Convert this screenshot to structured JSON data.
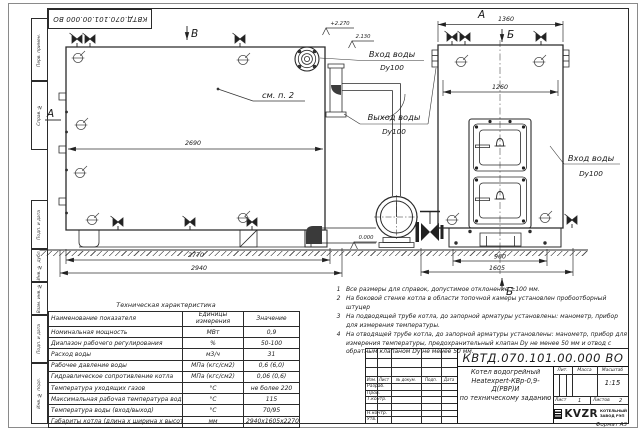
{
  "doc_number": "КВТД.070.101.00.000  ВО",
  "format_note": "Формат   А3",
  "margin_labels": {
    "perv_primen": "Перв. примен.",
    "sprav_no": "Справ. №",
    "podp_data_1": "Подп. и дата",
    "inv_dubl": "Инв. № дубл.",
    "vzam_inv": "Взам. инв. №",
    "podp_data_2": "Подп. и дата",
    "inv_podl": "Инв. № подл."
  },
  "side_view": {
    "view_b_label": "В",
    "view_a_label": "А",
    "see_note": "см. п. 2",
    "dim_top": "2690",
    "dim_mid": "2770",
    "dim_bottom": "2940",
    "elev_top": "+2.270",
    "elev_flue": "2.130",
    "elev_ground": "0.000",
    "inlet_label": "Вход воды",
    "inlet_dn": "Dy100",
    "outlet_label": "Выход воды",
    "outlet_dn": "Dy100"
  },
  "front_view": {
    "view_title": "А",
    "dim_top": "1360",
    "dim_inner": "1260",
    "dim_base": "960",
    "dim_overall": "1605",
    "section_top": "Б",
    "section_bottom": "Б",
    "inlet_label": "Вход воды",
    "inlet_dn": "Dy100"
  },
  "notes": [
    {
      "num": "1",
      "text": "Все размеры для справок, допустимое отклонение  ±100 мм."
    },
    {
      "num": "2",
      "text": "На боковой стенке котла в области топочной камеры установлен пробоотборный штуцер"
    },
    {
      "num": "3",
      "text": "На  подводящей трубе котла, до запорной арматуры установлены: манометр, прибор для измерения температуры."
    },
    {
      "num": "4",
      "text": "На отводящей трубе котла, до запорной арматуры установлены: манометр, прибор для измерения температуры, предохранительный клапан  Dy не менее  50 мм и отвод с обратным клапаном  Dy не менее 50 мм."
    }
  ],
  "spec_table": {
    "title": "Техническая характеристика",
    "headers": [
      "Наименование показателя",
      "Единицы измерения",
      "Значение"
    ],
    "rows": [
      [
        "Номинальная мощность",
        "МВт",
        "0,9"
      ],
      [
        "Диапазон рабочего регулирования",
        "%",
        "50-100"
      ],
      [
        "Расход воды",
        "м3/ч",
        "31"
      ],
      [
        "Рабочее давление воды",
        "МПа (кгс/см2)",
        "0,6 (6,0)"
      ],
      [
        "Гидравлическое сопротивление котла",
        "МПа (кгс/см2)",
        "0,06 (0,6)"
      ],
      [
        "Температура уходящих газов",
        "°С",
        "не более 220"
      ],
      [
        "Максимальная рабочая температура воды",
        "°С",
        "115"
      ],
      [
        "Температура воды (вход/выход)",
        "°С",
        "70/95"
      ],
      [
        "Габариты котла (длина х ширина х высота)",
        "мм",
        "2940х1605х2270"
      ]
    ]
  },
  "title_block": {
    "rev_cols": [
      "Изм.",
      "Лист",
      "№ докум.",
      "Подп.",
      "Дата"
    ],
    "sig_labels": [
      "Разраб.",
      "Пров.",
      "Т.контр.",
      "Н.контр.",
      "Утв."
    ],
    "product_name_1": "Котел водогрейный",
    "product_name_2": "Heatexpert-КВр-0,9-Д(РВР)И",
    "product_name_3": "по техническому заданию",
    "lit_label": "Лит.",
    "mass_label": "Масса",
    "scale_label": "Масштаб",
    "scale_value": "1:15",
    "sheet_label": "Лист",
    "sheet_value": "1",
    "sheets_label": "Листов",
    "sheets_value": "2",
    "logo_text": "KVZR",
    "company_line1": "КОТЕЛЬНЫЙ",
    "company_line2": "ЗАВОД РЭП"
  }
}
